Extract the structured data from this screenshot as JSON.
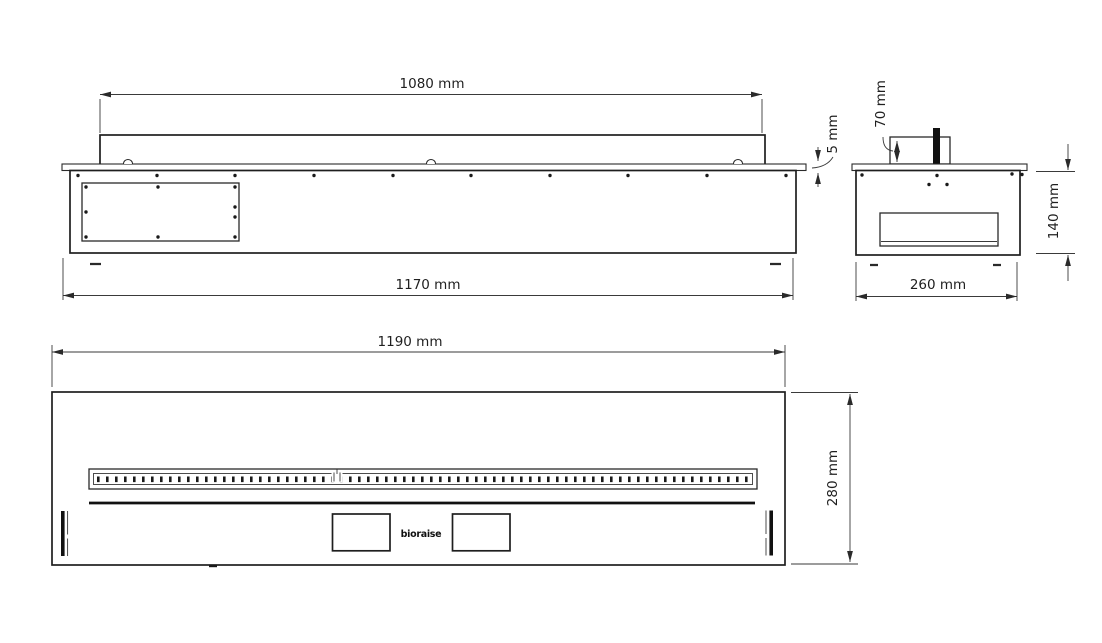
{
  "drawing": {
    "type": "technical-drawing",
    "subject": "bioethanol burner insert, three orthographic views",
    "unit": "mm",
    "views": {
      "front": {
        "label": "front view",
        "dims": {
          "burner_width": "1080 mm",
          "overall_width": "1170 mm",
          "top_plate_thickness": "5 mm"
        }
      },
      "side": {
        "label": "side view",
        "dims": {
          "regulator_height": "70 mm",
          "body_height": "140 mm",
          "overall_depth": "260 mm"
        }
      },
      "plan": {
        "label": "top view",
        "dims": {
          "overall_width": "1190 mm",
          "overall_depth": "280 mm"
        },
        "logo": "bioraise"
      }
    },
    "colors": {
      "line": "#2a2a2a",
      "background": "#ffffff",
      "accent_fill": "#111111"
    }
  }
}
